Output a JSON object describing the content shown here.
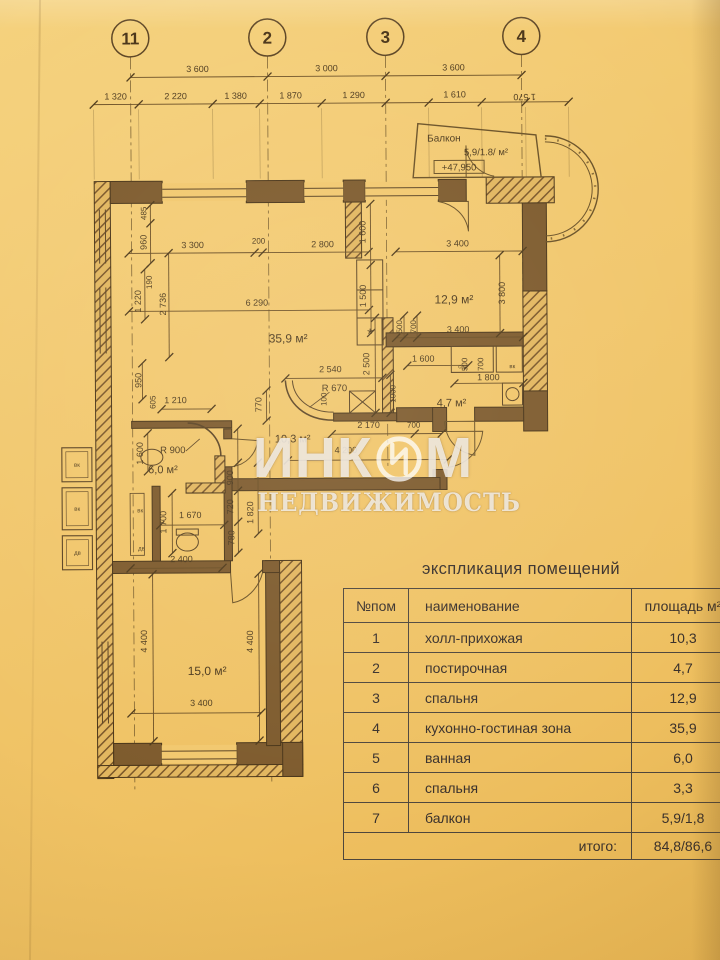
{
  "plan": {
    "axes": [
      {
        "label": "11",
        "x": 133
      },
      {
        "label": "2",
        "x": 270
      },
      {
        "label": "3",
        "x": 388
      },
      {
        "label": "4",
        "x": 524
      }
    ],
    "labels": [
      {
        "t": "3 600",
        "x": 200,
        "y": 71
      },
      {
        "t": "3 000",
        "x": 329,
        "y": 71
      },
      {
        "t": "3 600",
        "x": 456,
        "y": 71
      },
      {
        "t": "1 320",
        "x": 118,
        "y": 98
      },
      {
        "t": "2 220",
        "x": 178,
        "y": 98
      },
      {
        "t": "1 380",
        "x": 238,
        "y": 98
      },
      {
        "t": "1 870",
        "x": 293,
        "y": 98
      },
      {
        "t": "1 290",
        "x": 356,
        "y": 98
      },
      {
        "t": "1 610",
        "x": 457,
        "y": 98
      },
      {
        "t": "1 570",
        "x": 527,
        "y": 95,
        "r": 180
      },
      {
        "t": "Балкон",
        "x": 446,
        "y": 142,
        "s": 10,
        "n": "balcony-label"
      },
      {
        "t": "5,9/1.8/ м²",
        "x": 488,
        "y": 156,
        "s": 9.5,
        "n": "balcony-area"
      },
      {
        "t": "+47,950",
        "x": 461,
        "y": 171,
        "s": 9.5,
        "n": "level-mark"
      },
      {
        "t": "485",
        "x": 148,
        "y": 212,
        "r": -90,
        "s": 8
      },
      {
        "t": "960",
        "x": 148,
        "y": 241,
        "r": -90
      },
      {
        "t": "3 300",
        "x": 194,
        "y": 247
      },
      {
        "t": "200",
        "x": 260,
        "y": 243,
        "s": 8
      },
      {
        "t": "2 800",
        "x": 324,
        "y": 247
      },
      {
        "t": "3 400",
        "x": 459,
        "y": 247
      },
      {
        "t": "1 600",
        "x": 367,
        "y": 232,
        "r": -90
      },
      {
        "t": "1 500",
        "x": 367,
        "y": 296,
        "r": -90
      },
      {
        "t": "3 800",
        "x": 506,
        "y": 294,
        "r": -90
      },
      {
        "t": "190",
        "x": 153,
        "y": 281,
        "r": -90,
        "s": 8
      },
      {
        "t": "1 220",
        "x": 142,
        "y": 300,
        "r": -90
      },
      {
        "t": "2 736",
        "x": 167,
        "y": 303,
        "r": -90
      },
      {
        "t": "6 290",
        "x": 258,
        "y": 305
      },
      {
        "t": "35,9 м²",
        "x": 289,
        "y": 342,
        "s": 12,
        "n": "room-area-kitchen-living"
      },
      {
        "t": "12,9 м²",
        "x": 455,
        "y": 304,
        "s": 12,
        "n": "room-area-bedroom"
      },
      {
        "t": "500",
        "x": 403,
        "y": 327,
        "r": -90,
        "s": 8
      },
      {
        "t": "700",
        "x": 417,
        "y": 327,
        "r": -90,
        "s": 8
      },
      {
        "t": "3 400",
        "x": 459,
        "y": 333
      },
      {
        "t": "2 500",
        "x": 370,
        "y": 364,
        "r": -90
      },
      {
        "t": "1000",
        "x": 396,
        "y": 394,
        "r": -90,
        "s": 8
      },
      {
        "t": "2 540",
        "x": 331,
        "y": 372
      },
      {
        "t": "R 670",
        "x": 335,
        "y": 391,
        "s": 9.5,
        "n": "radius-label-r670"
      },
      {
        "t": "1 600",
        "x": 424,
        "y": 362
      },
      {
        "t": "500",
        "x": 468,
        "y": 365,
        "r": -90,
        "s": 8
      },
      {
        "t": "700",
        "x": 484,
        "y": 365,
        "r": -90,
        "s": 8
      },
      {
        "t": "1 800",
        "x": 489,
        "y": 381
      },
      {
        "t": "100",
        "x": 327,
        "y": 399,
        "r": -90,
        "s": 8
      },
      {
        "t": "770",
        "x": 262,
        "y": 404,
        "r": -90
      },
      {
        "t": "2 170",
        "x": 369,
        "y": 428
      },
      {
        "t": "700",
        "x": 414,
        "y": 428,
        "s": 8
      },
      {
        "t": "4 200",
        "x": 346,
        "y": 453
      },
      {
        "t": "10,3 м²",
        "x": 293,
        "y": 442,
        "s": 11,
        "n": "room-area-hall"
      },
      {
        "t": "4,7 м²",
        "x": 452,
        "y": 407,
        "s": 11,
        "n": "room-area-laundry"
      },
      {
        "t": "950",
        "x": 142,
        "y": 379,
        "r": -90
      },
      {
        "t": "605",
        "x": 156,
        "y": 401,
        "r": -90,
        "s": 8
      },
      {
        "t": "1 210",
        "x": 176,
        "y": 402
      },
      {
        "t": "R 900",
        "x": 173,
        "y": 452,
        "s": 9.5,
        "n": "radius-label-r900"
      },
      {
        "t": "1 600",
        "x": 143,
        "y": 452,
        "r": -90
      },
      {
        "t": "6,0 м²",
        "x": 163,
        "y": 472,
        "s": 11,
        "n": "room-area-bath"
      },
      {
        "t": "900",
        "x": 233,
        "y": 477,
        "r": -90
      },
      {
        "t": "720",
        "x": 233,
        "y": 506,
        "r": -90
      },
      {
        "t": "780",
        "x": 234,
        "y": 537,
        "r": -90
      },
      {
        "t": "1 820",
        "x": 253,
        "y": 512,
        "r": -90
      },
      {
        "t": "1 700",
        "x": 166,
        "y": 521,
        "r": -90
      },
      {
        "t": "1 670",
        "x": 190,
        "y": 517
      },
      {
        "t": "2 400",
        "x": 181,
        "y": 561
      },
      {
        "t": "4 400",
        "x": 146,
        "y": 640,
        "r": -90
      },
      {
        "t": "4 400",
        "x": 252,
        "y": 641,
        "r": -90
      },
      {
        "t": "15,0 м²",
        "x": 206,
        "y": 674,
        "s": 12,
        "n": "room-area-bedroom2"
      },
      {
        "t": "3 400",
        "x": 200,
        "y": 705
      },
      {
        "t": "*",
        "x": 371,
        "y": 339,
        "s": 15,
        "n": "stove-symbol"
      },
      {
        "t": "вк",
        "x": 77,
        "y": 465,
        "s": 6,
        "n": "shaft-label"
      },
      {
        "t": "вк",
        "x": 77,
        "y": 509,
        "s": 6,
        "n": "shaft-label"
      },
      {
        "t": "дв",
        "x": 77,
        "y": 553,
        "s": 6,
        "n": "shaft-label"
      },
      {
        "t": "вк",
        "x": 140,
        "y": 511,
        "s": 6,
        "n": "shaft-label"
      },
      {
        "t": "дв",
        "x": 141,
        "y": 549,
        "s": 6,
        "n": "shaft-label"
      },
      {
        "t": "св",
        "x": 462,
        "y": 369,
        "s": 6,
        "n": "cabinet-label"
      },
      {
        "t": "вк",
        "x": 513,
        "y": 369,
        "s": 6,
        "n": "cabinet-label"
      }
    ]
  },
  "watermark": {
    "part1": "ИНК",
    "part2": "М",
    "line2": "НЕДВИЖИМОСТЬ"
  },
  "table": {
    "title": "экспликация помещений",
    "headers": [
      "№пом",
      "наименование",
      "площадь м²"
    ],
    "rows": [
      [
        "1",
        "холл-прихожая",
        "10,3"
      ],
      [
        "2",
        "постирочная",
        "4,7"
      ],
      [
        "3",
        "спальня",
        "12,9"
      ],
      [
        "4",
        "кухонно-гостиная зона",
        "35,9"
      ],
      [
        "5",
        "ванная",
        "6,0"
      ],
      [
        "6",
        "спальня",
        "3,3"
      ],
      [
        "7",
        "балкон",
        "5,9/1,8"
      ]
    ],
    "total_label": "итого:",
    "total_value": "84,8/86,6"
  }
}
